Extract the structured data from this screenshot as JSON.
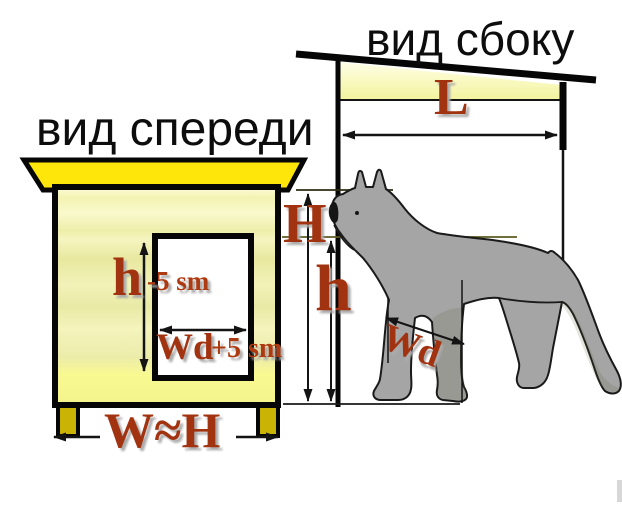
{
  "diagram": {
    "side_view": {
      "title": "вид сбоку",
      "length_label": "L"
    },
    "front_view": {
      "title": "вид спереди",
      "door_height": {
        "main": "h",
        "offset": "-5 sm"
      },
      "door_width": {
        "main": "Wd",
        "offset": "+5 sm"
      },
      "base_width_label": "W≈H"
    },
    "dog": {
      "total_height_label": "H",
      "nose_height_label": "h",
      "chest_width_label": "Wd"
    }
  },
  "colors": {
    "roof_yellow": "#ffe60a",
    "wall_cream": "#f2f2b4",
    "foot_olive": "#c9b406",
    "dog_gray": "#a5a5a5",
    "label_red": "#a23310",
    "outline": "#111111"
  }
}
